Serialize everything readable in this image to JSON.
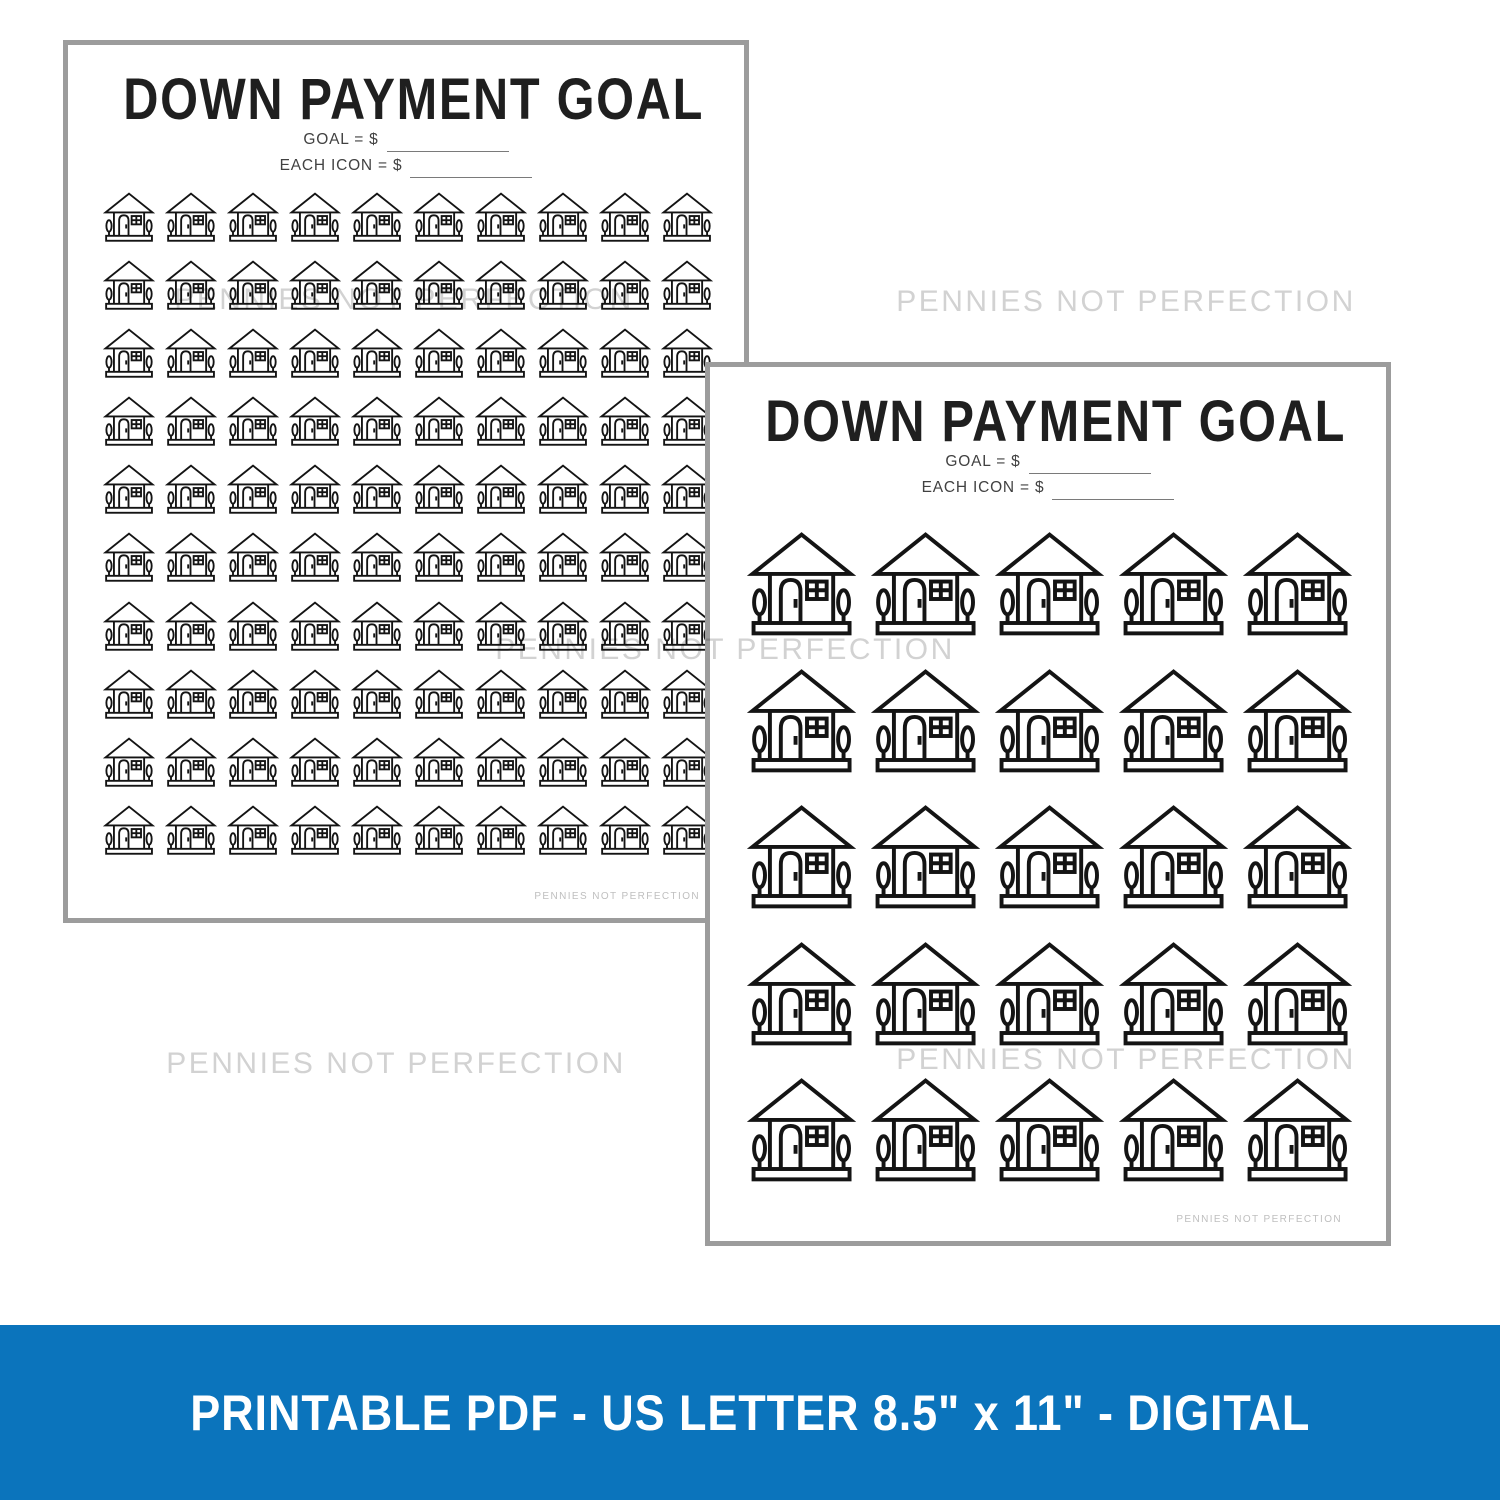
{
  "watermark_text": "PENNIES NOT PERFECTION",
  "banner": {
    "label": "PRINTABLE PDF - US LETTER 8.5\" x 11\" - DIGITAL",
    "bg_color": "#0b74bc",
    "text_color": "#ffffff"
  },
  "pages": [
    {
      "title": "DOWN PAYMENT GOAL",
      "goal_label": "GOAL = $",
      "each_icon_label": "EACH ICON = $",
      "footer_credit": "PENNIES NOT PERFECTION",
      "grid": {
        "rows": 10,
        "cols": 10,
        "icon": "house-icon",
        "total_icons": 100
      }
    },
    {
      "title": "DOWN PAYMENT GOAL",
      "goal_label": "GOAL = $",
      "each_icon_label": "EACH ICON = $",
      "footer_credit": "PENNIES NOT PERFECTION",
      "grid": {
        "rows": 5,
        "cols": 5,
        "icon": "house-icon",
        "total_icons": 25
      }
    }
  ],
  "colors": {
    "page_border": "#9c9c9c",
    "icon_stroke": "#141414",
    "watermark": "#d2d2d2",
    "banner_bg": "#0b74bc"
  }
}
